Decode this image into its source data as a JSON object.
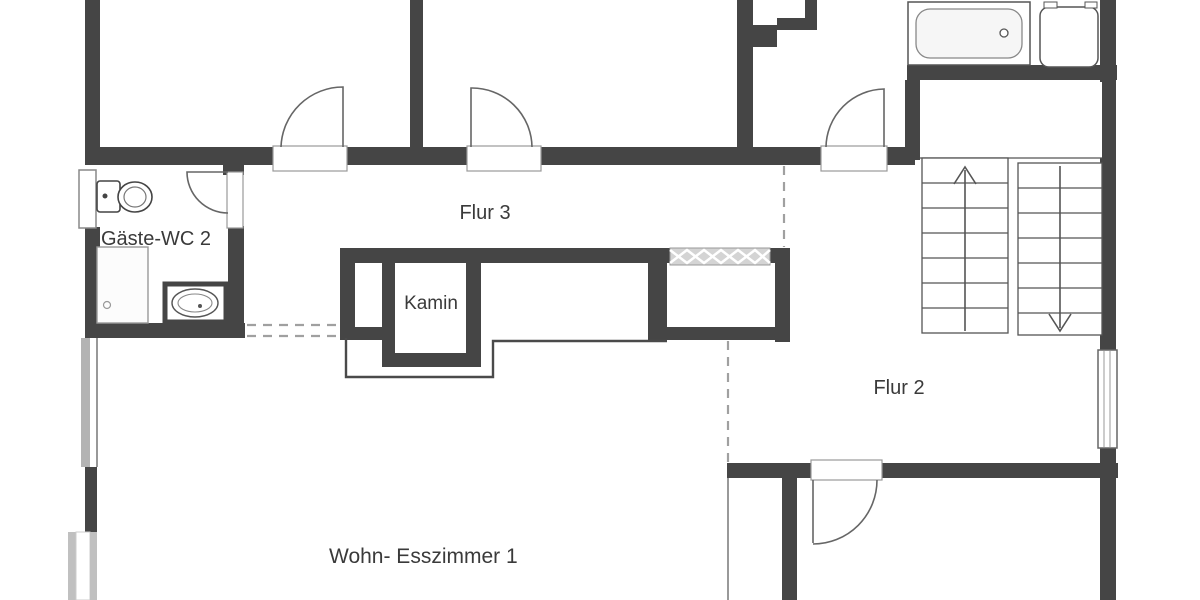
{
  "plan": {
    "type": "floor-plan",
    "language": "de",
    "labels": {
      "guest_wc": "Gäste-WC 2",
      "hallway3": "Flur 3",
      "fireplace": "Kamin",
      "hallway2": "Flur 2",
      "living_dining": "Wohn- Esszimmer 1"
    },
    "colors": {
      "wall": "#454545",
      "background": "#ffffff",
      "door_arc": "#666666",
      "window_frame": "#b3b3b3",
      "dashed_line": "#a0a0a0",
      "text": "#3a3a3a",
      "vent_hatch": "#d4d4d4"
    },
    "stairs": {
      "up_flight_steps": 7,
      "down_flight_steps": 7
    }
  }
}
